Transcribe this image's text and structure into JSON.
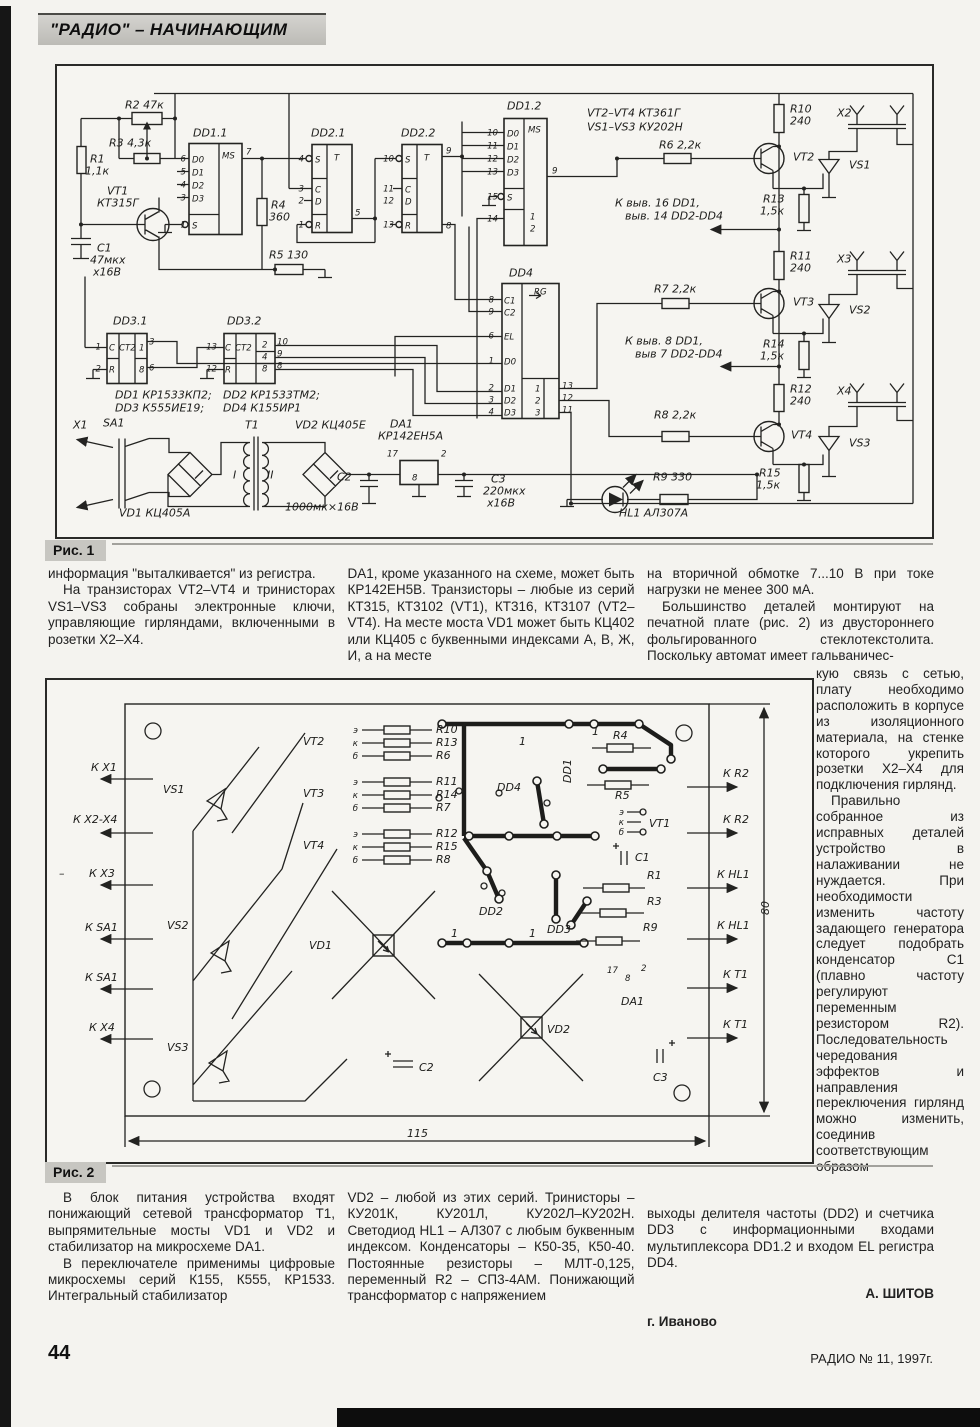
{
  "page": {
    "header_title": "\"РАДИО\" – НАЧИНАЮЩИМ"
  },
  "footer": {
    "page_number": "44",
    "issue": "РАДИО № 11, 1997г."
  },
  "fig1": {
    "caption": "Рис. 1",
    "labels": [
      [
        68,
        42,
        "R2 47к"
      ],
      [
        33,
        96,
        "R1"
      ],
      [
        28,
        108,
        "1,1к"
      ],
      [
        52,
        80,
        "R3 4,3к"
      ],
      [
        50,
        128,
        "VT1"
      ],
      [
        40,
        140,
        "КТ315Г"
      ],
      [
        40,
        185,
        "C1"
      ],
      [
        33,
        197,
        "47мкх"
      ],
      [
        36,
        209,
        "х16В"
      ],
      [
        136,
        70,
        "DD1.1"
      ],
      [
        254,
        70,
        "DD2.1"
      ],
      [
        344,
        70,
        "DD2.2"
      ],
      [
        450,
        43,
        "DD1.2"
      ],
      [
        530,
        50,
        "VT2–VT4  КТ361Г"
      ],
      [
        530,
        64,
        "VS1–VS3  КУ202Н"
      ],
      [
        214,
        142,
        "R4"
      ],
      [
        212,
        154,
        "360"
      ],
      [
        212,
        192,
        "R5 130"
      ],
      [
        452,
        210,
        "DD4"
      ],
      [
        602,
        82,
        "R6 2,2к"
      ],
      [
        558,
        140,
        "К выв. 16 DD1,"
      ],
      [
        568,
        153,
        "выв. 14 DD2-DD4"
      ],
      [
        597,
        226,
        "R7 2,2к"
      ],
      [
        568,
        278,
        "К выв. 8 DD1,"
      ],
      [
        578,
        291,
        "выв 7 DD2-DD4"
      ],
      [
        597,
        352,
        "R8 2,2к"
      ],
      [
        733,
        46,
        "R10"
      ],
      [
        733,
        58,
        "240"
      ],
      [
        736,
        94,
        "VT2"
      ],
      [
        780,
        50,
        "Х2"
      ],
      [
        792,
        102,
        "VS1"
      ],
      [
        706,
        136,
        "R13"
      ],
      [
        703,
        148,
        "1,5к"
      ],
      [
        733,
        193,
        "R11"
      ],
      [
        733,
        205,
        "240"
      ],
      [
        736,
        239,
        "VT3"
      ],
      [
        780,
        196,
        "Х3"
      ],
      [
        792,
        247,
        "VS2"
      ],
      [
        706,
        281,
        "R14"
      ],
      [
        703,
        293,
        "1,5к"
      ],
      [
        733,
        326,
        "R12"
      ],
      [
        733,
        338,
        "240"
      ],
      [
        734,
        372,
        "VT4"
      ],
      [
        780,
        328,
        "Х4"
      ],
      [
        792,
        380,
        "VS3"
      ],
      [
        702,
        410,
        "R15"
      ],
      [
        699,
        422,
        "1,5к"
      ],
      [
        56,
        258,
        "DD3.1"
      ],
      [
        170,
        258,
        "DD3.2"
      ],
      [
        58,
        332,
        "DD1  КР1533КП2;"
      ],
      [
        166,
        332,
        "DD2  КР1533ТМ2;"
      ],
      [
        58,
        345,
        "DD3  К555ИЕ19;"
      ],
      [
        166,
        345,
        "DD4  К155ИР1"
      ],
      [
        16,
        362,
        "Х1"
      ],
      [
        46,
        360,
        "SA1"
      ],
      [
        62,
        450,
        "VD1  КЦ405А"
      ],
      [
        188,
        362,
        "Т1"
      ],
      [
        176,
        412,
        "I"
      ],
      [
        210,
        412,
        "II"
      ],
      [
        238,
        362,
        "VD2 КЦ405Е"
      ],
      [
        280,
        414,
        "С2"
      ],
      [
        228,
        444,
        "1000мк×16В"
      ],
      [
        333,
        361,
        "DA1"
      ],
      [
        321,
        373,
        "КР142ЕН5А"
      ],
      [
        434,
        416,
        "С3"
      ],
      [
        426,
        428,
        "220мкх"
      ],
      [
        430,
        440,
        "х16В"
      ],
      [
        596,
        414,
        "R9 330"
      ],
      [
        562,
        450,
        "HL1 АЛ307А"
      ],
      [
        129,
        95,
        "6",
        "se"
      ],
      [
        129,
        108,
        "5",
        "se"
      ],
      [
        129,
        121,
        "4",
        "se"
      ],
      [
        129,
        134,
        "3",
        "se"
      ],
      [
        129,
        161,
        "1",
        "se"
      ],
      [
        135,
        96,
        "D0",
        "s"
      ],
      [
        135,
        109,
        "D1",
        "s"
      ],
      [
        135,
        122,
        "D2",
        "s"
      ],
      [
        135,
        135,
        "D3",
        "s"
      ],
      [
        135,
        162,
        "S",
        "s"
      ],
      [
        165,
        92,
        "MS",
        "s"
      ],
      [
        189,
        88,
        "7",
        "s"
      ],
      [
        247,
        95,
        "4",
        "se"
      ],
      [
        247,
        125,
        "3",
        "se"
      ],
      [
        247,
        137,
        "2",
        "se"
      ],
      [
        247,
        161,
        "1",
        "se"
      ],
      [
        258,
        96,
        "S",
        "s"
      ],
      [
        258,
        126,
        "C",
        "s"
      ],
      [
        258,
        138,
        "D",
        "s"
      ],
      [
        258,
        162,
        "R",
        "s"
      ],
      [
        277,
        94,
        "T",
        "s"
      ],
      [
        298,
        149,
        "5",
        "s"
      ],
      [
        337,
        95,
        "10",
        "se"
      ],
      [
        337,
        125,
        "11",
        "se"
      ],
      [
        337,
        137,
        "12",
        "se"
      ],
      [
        337,
        161,
        "13",
        "se"
      ],
      [
        348,
        96,
        "S",
        "s"
      ],
      [
        348,
        126,
        "C",
        "s"
      ],
      [
        348,
        138,
        "D",
        "s"
      ],
      [
        348,
        162,
        "R",
        "s"
      ],
      [
        367,
        94,
        "T",
        "s"
      ],
      [
        389,
        87,
        "9",
        "s"
      ],
      [
        389,
        162,
        "8",
        "s"
      ],
      [
        441,
        69,
        "10",
        "se"
      ],
      [
        441,
        82,
        "11",
        "se"
      ],
      [
        441,
        95,
        "12",
        "se"
      ],
      [
        441,
        108,
        "13",
        "se"
      ],
      [
        441,
        133,
        "15",
        "se"
      ],
      [
        441,
        155,
        "14",
        "se"
      ],
      [
        450,
        70,
        "D0",
        "s"
      ],
      [
        450,
        83,
        "D1",
        "s"
      ],
      [
        450,
        96,
        "D2",
        "s"
      ],
      [
        450,
        109,
        "D3",
        "s"
      ],
      [
        450,
        134,
        "S",
        "s"
      ],
      [
        471,
        66,
        "MS",
        "s"
      ],
      [
        473,
        153,
        "1",
        "s"
      ],
      [
        473,
        165,
        "2",
        "s"
      ],
      [
        495,
        107,
        "9",
        "s"
      ],
      [
        437,
        236,
        "8",
        "se"
      ],
      [
        437,
        248,
        "9",
        "se"
      ],
      [
        437,
        272,
        "6",
        "se"
      ],
      [
        437,
        297,
        "1",
        "se"
      ],
      [
        437,
        324,
        "2",
        "se"
      ],
      [
        437,
        336,
        "3",
        "se"
      ],
      [
        437,
        348,
        "4",
        "se"
      ],
      [
        447,
        237,
        "C1",
        "s"
      ],
      [
        447,
        249,
        "C2",
        "s"
      ],
      [
        447,
        273,
        "EL",
        "s"
      ],
      [
        447,
        298,
        "D0",
        "s"
      ],
      [
        447,
        325,
        "D1",
        "s"
      ],
      [
        447,
        337,
        "D2",
        "s"
      ],
      [
        447,
        349,
        "D3",
        "s"
      ],
      [
        477,
        228,
        "RG",
        "s"
      ],
      [
        478,
        325,
        "1",
        "s"
      ],
      [
        478,
        337,
        "2",
        "s"
      ],
      [
        478,
        349,
        "3",
        "s"
      ],
      [
        505,
        322,
        "13",
        "s"
      ],
      [
        505,
        334,
        "12",
        "s"
      ],
      [
        505,
        346,
        "11",
        "s"
      ],
      [
        44,
        283,
        "1",
        "se"
      ],
      [
        44,
        305,
        "2",
        "se"
      ],
      [
        52,
        284,
        "C",
        "s"
      ],
      [
        52,
        306,
        "R",
        "s"
      ],
      [
        62,
        284,
        "CT2",
        "s"
      ],
      [
        82,
        284,
        "1",
        "s"
      ],
      [
        82,
        306,
        "8",
        "s"
      ],
      [
        92,
        278,
        "3",
        "s"
      ],
      [
        92,
        304,
        "6",
        "s"
      ],
      [
        160,
        283,
        "13",
        "se"
      ],
      [
        160,
        305,
        "12",
        "se"
      ],
      [
        168,
        284,
        "C",
        "s"
      ],
      [
        168,
        306,
        "R",
        "s"
      ],
      [
        178,
        284,
        "CT2",
        "s"
      ],
      [
        205,
        281,
        "2",
        "s"
      ],
      [
        205,
        293,
        "4",
        "s"
      ],
      [
        205,
        305,
        "8",
        "s"
      ],
      [
        220,
        278,
        "10",
        "s"
      ],
      [
        220,
        290,
        "9",
        "s"
      ],
      [
        220,
        302,
        "8",
        "s"
      ],
      [
        330,
        390,
        "17",
        "s"
      ],
      [
        384,
        390,
        "2",
        "s"
      ],
      [
        355,
        414,
        "8",
        "s"
      ]
    ]
  },
  "fig2": {
    "caption": "Рис. 2",
    "labels": [
      [
        44,
        90,
        "К Х1"
      ],
      [
        26,
        142,
        "К Х2-Х4"
      ],
      [
        12,
        196,
        "–"
      ],
      [
        42,
        196,
        "К Х3"
      ],
      [
        38,
        250,
        "К SA1"
      ],
      [
        38,
        300,
        "К SA1"
      ],
      [
        42,
        350,
        "К Х4"
      ],
      [
        256,
        64,
        "VT2"
      ],
      [
        256,
        116,
        "VT3"
      ],
      [
        256,
        168,
        "VT4"
      ],
      [
        116,
        112,
        "VS1"
      ],
      [
        120,
        248,
        "VS2"
      ],
      [
        120,
        370,
        "VS3"
      ],
      [
        311,
        52,
        "э",
        "se"
      ],
      [
        311,
        65,
        "к",
        "se"
      ],
      [
        311,
        78,
        "б",
        "se"
      ],
      [
        311,
        104,
        "э",
        "se"
      ],
      [
        311,
        117,
        "к",
        "se"
      ],
      [
        311,
        130,
        "б",
        "se"
      ],
      [
        311,
        156,
        "э",
        "se"
      ],
      [
        311,
        169,
        "к",
        "se"
      ],
      [
        311,
        182,
        "б",
        "se"
      ],
      [
        389,
        52,
        "R10"
      ],
      [
        389,
        65,
        "R13"
      ],
      [
        389,
        78,
        "R6"
      ],
      [
        389,
        104,
        "R11"
      ],
      [
        389,
        117,
        "R14"
      ],
      [
        389,
        130,
        "R7"
      ],
      [
        389,
        156,
        "R12"
      ],
      [
        389,
        169,
        "R15"
      ],
      [
        389,
        182,
        "R8"
      ],
      [
        450,
        110,
        "DD4"
      ],
      [
        524,
        102,
        "DD1",
        "v"
      ],
      [
        432,
        234,
        "DD2"
      ],
      [
        500,
        252,
        "DD3"
      ],
      [
        472,
        64,
        "1"
      ],
      [
        545,
        54,
        "1"
      ],
      [
        404,
        256,
        "1"
      ],
      [
        482,
        256,
        "1"
      ],
      [
        566,
        58,
        "R4"
      ],
      [
        568,
        118,
        "R5"
      ],
      [
        600,
        198,
        "R1"
      ],
      [
        600,
        224,
        "R3"
      ],
      [
        596,
        250,
        "R9"
      ],
      [
        577,
        134,
        "э",
        "se"
      ],
      [
        577,
        144,
        "к",
        "se"
      ],
      [
        577,
        154,
        "б",
        "se"
      ],
      [
        602,
        146,
        "VT1"
      ],
      [
        588,
        180,
        "С1"
      ],
      [
        606,
        400,
        "С3"
      ],
      [
        372,
        390,
        "С2"
      ],
      [
        560,
        292,
        "17",
        "s"
      ],
      [
        578,
        300,
        "8",
        "s"
      ],
      [
        594,
        290,
        "2",
        "s"
      ],
      [
        574,
        324,
        "DA1"
      ],
      [
        262,
        268,
        "VD1"
      ],
      [
        500,
        352,
        "VD2"
      ],
      [
        676,
        96,
        "К R2"
      ],
      [
        676,
        142,
        "К R2"
      ],
      [
        670,
        197,
        "К HL1"
      ],
      [
        670,
        248,
        "К HL1"
      ],
      [
        676,
        297,
        "К Т1"
      ],
      [
        676,
        347,
        "К Т1"
      ],
      [
        722,
        234,
        "80",
        "v"
      ],
      [
        360,
        456,
        "115"
      ]
    ]
  },
  "article": {
    "r1c1_p1": "информация \"выталкивается\" из регистра.",
    "r1c1_p2": "На транзисторах VT2–VT4 и тринисторах VS1–VS3 собраны электронные ключи, управляющие гирляндами, включенными в розетки Х2–Х4.",
    "r1c2_p1": "DA1, кроме указанного на схеме, может быть КР142ЕН5В. Транзисторы – любые из серий КТ315, КТ3102 (VT1), КТ316, КТ3107 (VT2–VT4). На месте моста VD1 может быть КЦ402 или КЦ405 с буквенными индексами А, В, Ж, И, а на месте",
    "r1c3_p1": "на вторичной обмотке 7...10 В при токе нагрузки не менее 300 мА.",
    "r1c3_p2": "Большинство деталей монтируют на печатной плате (рис. 2) из двустороннего фольгированного стеклотекстолита. Поскольку автомат имеет гальваничес-",
    "side_p1": "кую связь с сетью, плату необходимо расположить в корпусе из изоляционного материала, на стенке которого укрепить розетки Х2–Х4 для подключения гирлянд.",
    "side_p2": "Правильно собранное из исправных деталей устройство в налаживании не нуждается. При необходимости изменить частоту задающего генератора следует подобрать конденсатор С1 (плавно частоту регулируют переменным резистором R2). Последовательность чередования эффектов и направления переключения гирлянд можно изменить, соединив соответствующим образом",
    "r2c1_p1": "В блок питания устройства входят понижающий сетевой трансформатор Т1, выпрямительные мосты VD1 и VD2 и стабилизатор на микросхеме DA1.",
    "r2c1_p2": "В переключателе применимы цифровые микросхемы серий К155, К555, КР1533. Интегральный стабилизатор",
    "r2c2_p1": "VD2 – любой из этих серий. Тринисторы – КУ201К, КУ201Л, КУ202Л–КУ202Н. Светодиод HL1 – АЛ307 с любым буквенным индексом. Конденсаторы – К50-35, К50-40. Постоянные резисторы – МЛТ-0,125, переменный R2 – СП3-4АМ. Понижающий трансформатор с напряжением",
    "r2c3_p1": "выходы делителя частоты (DD2) и счетчика DD3 с информационными входами мультиплексора DD1.2 и входом EL регистра DD4.",
    "author": "А. ШИТОВ",
    "city": "г. Иваново"
  }
}
